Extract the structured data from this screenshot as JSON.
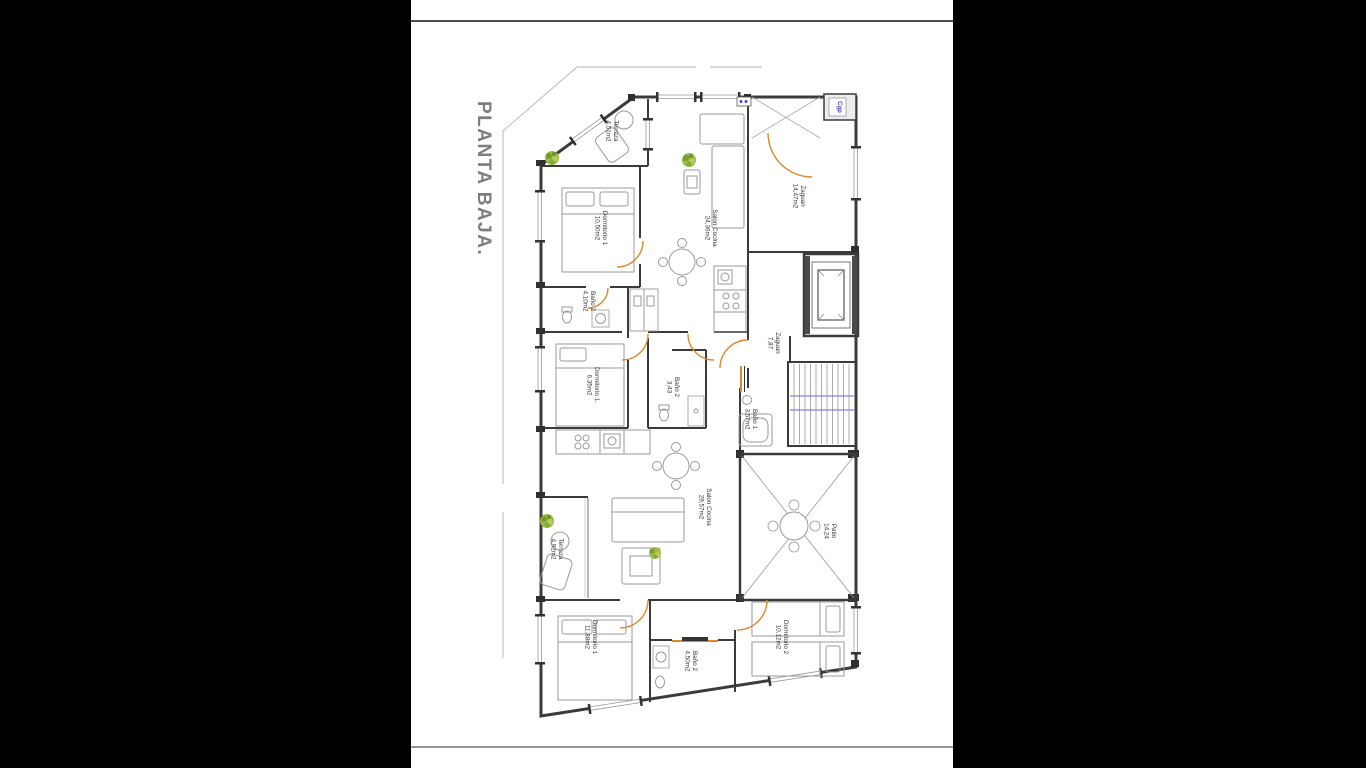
{
  "page": {
    "title": "PLANTA BAJA."
  },
  "plan": {
    "rooms": [
      {
        "name": "Terraza",
        "area": "4,51m2"
      },
      {
        "name": "Dormitorio 1",
        "area": "10,50m2"
      },
      {
        "name": "Salon Cocina",
        "area": "24,36m2"
      },
      {
        "name": "Zaguan",
        "area": "14,47m2"
      },
      {
        "name": "Baño 2",
        "area": "4,10m2"
      },
      {
        "name": "Dormitorio 1.",
        "area": "6,35m2"
      },
      {
        "name": "Baño 2",
        "area": "3,43"
      },
      {
        "name": "Zaguan",
        "area": "7,87"
      },
      {
        "name": "Baño 1",
        "area": "3,57m2"
      },
      {
        "name": "Salon Cocina",
        "area": "29,57m2"
      },
      {
        "name": "Terraza",
        "area": "4,92m2"
      },
      {
        "name": "Patio",
        "area": "14,24"
      },
      {
        "name": "Dormitorio 1",
        "area": "11,88m2"
      },
      {
        "name": "Baño 2",
        "area": "4,50m2"
      },
      {
        "name": "Dormitorio 2",
        "area": "10,12m2"
      }
    ],
    "annotations": {
      "utility_box": "Cgp"
    },
    "colors": {
      "wall": "#3b3b3b",
      "door": "#e0862c",
      "stair_rail": "#8585d6",
      "plant": "#9cbb44",
      "title": "#7e7e7e",
      "annotation": "#4646c8"
    }
  }
}
